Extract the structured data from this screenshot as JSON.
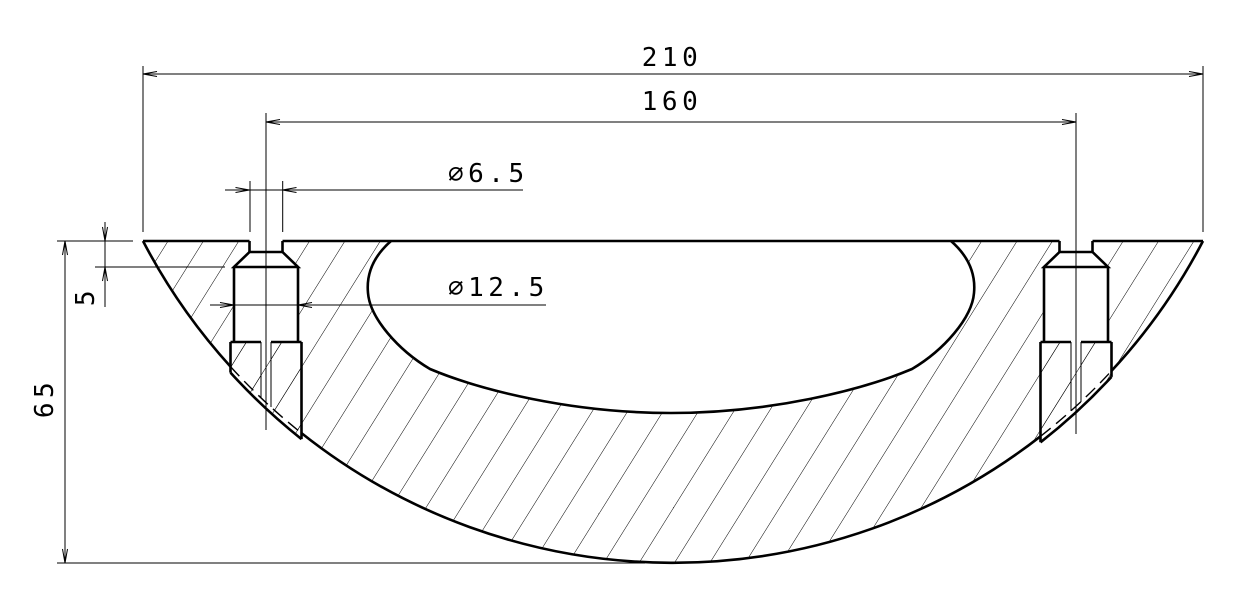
{
  "drawing": {
    "type": "engineering-section-view",
    "line_color": "#000000",
    "background_color": "#ffffff",
    "dimensions": {
      "overall_width": "210",
      "hole_spacing": "160",
      "hole_diameter": "∅6.5",
      "counterbore_diameter": "∅12.5",
      "countersink_depth": "5",
      "overall_height": "65"
    }
  }
}
